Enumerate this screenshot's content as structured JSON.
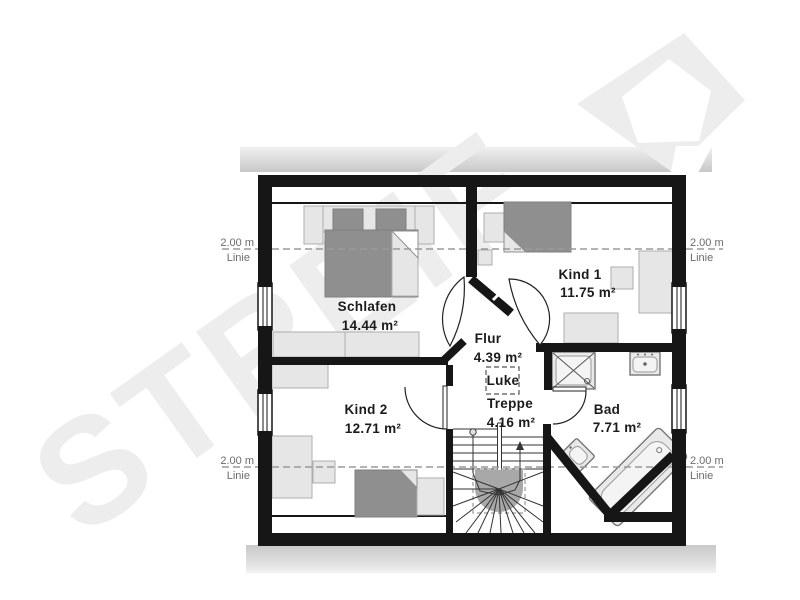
{
  "plan": {
    "watermark": "STREIF",
    "rooms": [
      {
        "name": "Schlafen",
        "area": "14.44 m²"
      },
      {
        "name": "Kind 1",
        "area": "11.75 m²"
      },
      {
        "name": "Kind 2",
        "area": "12.71 m²"
      },
      {
        "name": "Flur",
        "area": "4.39 m²"
      },
      {
        "name": "Bad",
        "area": "7.71 m²"
      }
    ],
    "stairs": {
      "label": "Treppe",
      "area": "4.16 m²"
    },
    "attic_hatch": {
      "label": "Luke"
    },
    "height_markers": [
      {
        "position": "left-upper",
        "label": "2.00 m",
        "sub": "Linie"
      },
      {
        "position": "right-upper",
        "label": "2.00 m",
        "sub": "Linie"
      },
      {
        "position": "left-lower",
        "label": "2.00 m",
        "sub": "Linie"
      },
      {
        "position": "right-lower",
        "label": "2.00 m",
        "sub": "Linie"
      }
    ],
    "colors": {
      "wall": "#161616",
      "furniture_dark": "#8f8f8f",
      "furniture_light": "#e6e6e6",
      "eaves_bar": "#c9c9c9",
      "dashed_line": "#9a9a9a",
      "watermark": "#ededed"
    }
  }
}
